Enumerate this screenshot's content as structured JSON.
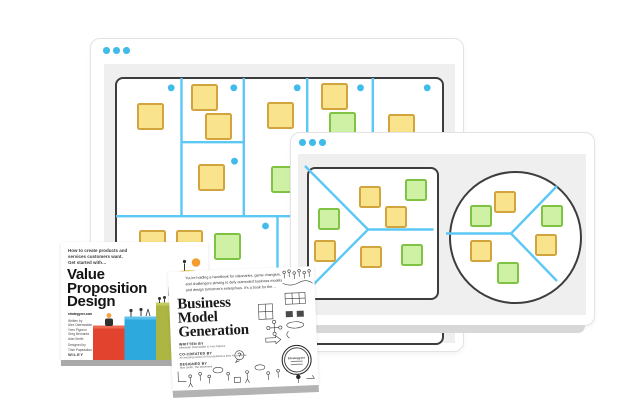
{
  "colors": {
    "accent_blue": "#41BBEA",
    "line_blue": "#5BC8F5",
    "sticky_yellow_fill": "#F9E38C",
    "sticky_yellow_border": "#D2A43E",
    "sticky_green_fill": "#CFF1A6",
    "sticky_green_border": "#80C344",
    "canvas_border": "#3D3D3D",
    "window_panel": "#EFEFEF"
  },
  "back_window": {
    "label": "business-model-canvas-board",
    "traffic_dots": 3,
    "canvas": {
      "width": 325,
      "height": 264,
      "sticky_size": 27,
      "lines": [
        [
          67.5,
          2,
          67.5,
          140.2
        ],
        [
          129.8,
          2,
          129.8,
          140.2
        ],
        [
          193.2,
          2,
          193.2,
          140.2
        ],
        [
          258.8,
          2,
          258.8,
          140.2
        ],
        [
          67.5,
          66.2,
          129.8,
          66.2
        ],
        [
          2,
          140.2,
          323,
          140.2
        ],
        [
          163.5,
          140.2,
          163.5,
          262
        ]
      ],
      "dots": [
        [
          57.2,
          11.8
        ],
        [
          119.8,
          11.8
        ],
        [
          183.2,
          11.8
        ],
        [
          246.5,
          11.8
        ],
        [
          313.2,
          11.8
        ],
        [
          120.5,
          85.2
        ],
        [
          151.5,
          150
        ]
      ],
      "stickies": [
        {
          "x": 22.5,
          "y": 26.5,
          "color": "yellow"
        },
        {
          "x": 76.5,
          "y": 7.5,
          "color": "yellow"
        },
        {
          "x": 90.5,
          "y": 36.5,
          "color": "yellow"
        },
        {
          "x": 83.5,
          "y": 87.5,
          "color": "yellow"
        },
        {
          "x": 152.5,
          "y": 25.5,
          "color": "yellow"
        },
        {
          "x": 156.5,
          "y": 89.5,
          "color": "green"
        },
        {
          "x": 206.5,
          "y": 6.5,
          "color": "yellow"
        },
        {
          "x": 214.5,
          "y": 35.5,
          "color": "green"
        },
        {
          "x": 273.5,
          "y": 37.5,
          "color": "yellow"
        },
        {
          "x": 24.5,
          "y": 153.5,
          "color": "yellow"
        },
        {
          "x": 61.5,
          "y": 153.5,
          "color": "yellow"
        },
        {
          "x": 99.5,
          "y": 156.5,
          "color": "green"
        }
      ]
    }
  },
  "front_window": {
    "label": "value-proposition-canvas-board",
    "traffic_dots": 3,
    "overlay": {
      "width": 303,
      "height": 192,
      "sticky_size": 22,
      "lines": [
        [
          18,
          37,
          81,
          100.5
        ],
        [
          18,
          164,
          81,
          100.5
        ],
        [
          81,
          100.5,
          146.5,
          100.5
        ],
        [
          159,
          104.5,
          224,
          104.5
        ],
        [
          224,
          104.5,
          270,
          57
        ],
        [
          224,
          104.5,
          270,
          152
        ]
      ],
      "dots": [],
      "stickies": [
        {
          "x": 118,
          "y": 50,
          "color": "green"
        },
        {
          "x": 72,
          "y": 57,
          "color": "yellow"
        },
        {
          "x": 98,
          "y": 77,
          "color": "yellow"
        },
        {
          "x": 31,
          "y": 79,
          "color": "green"
        },
        {
          "x": 27,
          "y": 111,
          "color": "yellow"
        },
        {
          "x": 73,
          "y": 117,
          "color": "yellow"
        },
        {
          "x": 114,
          "y": 115,
          "color": "green"
        },
        {
          "x": 207,
          "y": 62,
          "color": "yellow"
        },
        {
          "x": 183,
          "y": 76,
          "color": "green"
        },
        {
          "x": 254,
          "y": 76,
          "color": "green"
        },
        {
          "x": 248,
          "y": 105,
          "color": "yellow"
        },
        {
          "x": 183,
          "y": 111,
          "color": "yellow"
        },
        {
          "x": 210,
          "y": 133,
          "color": "green"
        }
      ]
    }
  },
  "books": {
    "vpd": {
      "tagline_lines": [
        "How to create products and",
        "services customers want.",
        "Get started with…"
      ],
      "title_lines": [
        "Value",
        "Proposition",
        "Design"
      ],
      "credit_lines": [
        "strategyzer.com",
        "",
        "Written by",
        "Alex Osterwalder",
        "Yves Pigneur",
        "Greg Bernarda",
        "Alan Smith",
        "",
        "Designed by",
        "Trish Papadakos"
      ],
      "publisher": "WILEY"
    },
    "bmg": {
      "tagline_lines": [
        "You're holding a handbook for visionaries, game changers,",
        "and challengers striving to defy outmoded business models",
        "and design tomorrow's enterprises. It's a book for the…"
      ],
      "title_lines": [
        "Business",
        "Model",
        "Generation"
      ],
      "credits": [
        {
          "label": "WRITTEN BY",
          "value": "Alexander Osterwalder & Yves Pigneur"
        },
        {
          "label": "CO-CREATED BY",
          "value": "An amazing crowd of 470 practitioners from 45 countries"
        },
        {
          "label": "DESIGNED BY",
          "value": "Alan Smith, The Movement"
        }
      ],
      "badge_label": "Strategyzer"
    }
  }
}
